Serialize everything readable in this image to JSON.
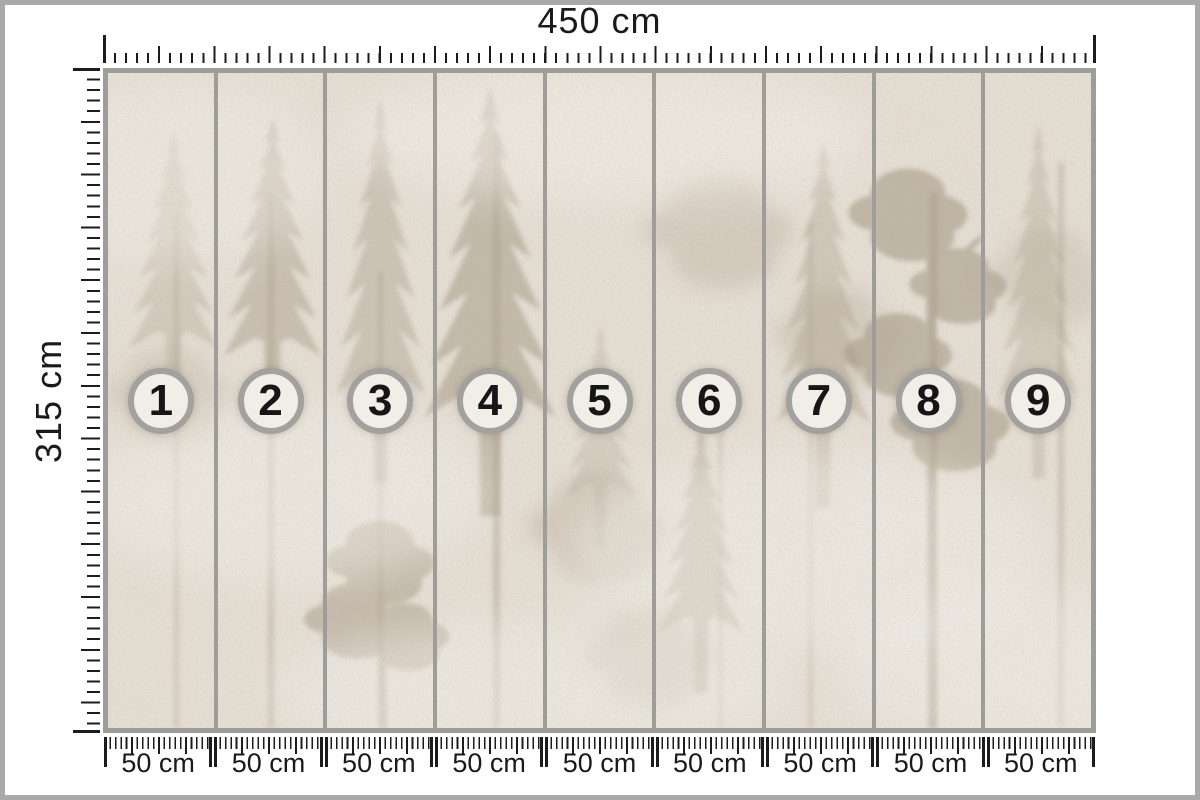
{
  "window": {
    "width_px": 1200,
    "height_px": 800,
    "background": "#ffffff",
    "frame_color": "#a9a9a9"
  },
  "rulers": {
    "tick_color": "#1c1c1c",
    "top": {
      "label": "450 cm"
    },
    "left": {
      "label": "315 cm"
    },
    "bottom": {
      "segments": [
        {
          "label": "50 cm"
        },
        {
          "label": "50 cm"
        },
        {
          "label": "50 cm"
        },
        {
          "label": "50 cm"
        },
        {
          "label": "50 cm"
        },
        {
          "label": "50 cm"
        },
        {
          "label": "50 cm"
        },
        {
          "label": "50 cm"
        },
        {
          "label": "50 cm"
        }
      ]
    }
  },
  "mural": {
    "frame_color": "#9e9d9a",
    "panel_count": 9,
    "panels": [
      {
        "number": "1"
      },
      {
        "number": "2"
      },
      {
        "number": "3"
      },
      {
        "number": "4"
      },
      {
        "number": "5"
      },
      {
        "number": "6"
      },
      {
        "number": "7"
      },
      {
        "number": "8"
      },
      {
        "number": "9"
      }
    ],
    "badge": {
      "fill": "#f1eee7",
      "border_color": "#a3a19e",
      "number_color": "#161616"
    },
    "texture": {
      "description": "foggy forest with faded pine trees",
      "base_color": "#e7e1d7",
      "tree_color": "#a89a86",
      "fog_color": "#f4f1eb"
    }
  }
}
